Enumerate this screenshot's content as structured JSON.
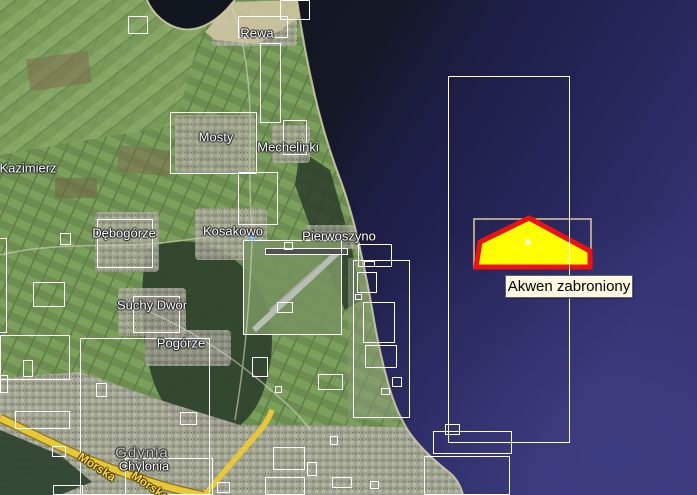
{
  "map": {
    "view_name": "satellite-map-coastal-bay",
    "restricted_area": {
      "label": "Akwen zabroniony",
      "polygon_points": "529,218 590,251 590,267 476,267 480,242",
      "fill_color": "#ffff00",
      "border_color": "#ee1111",
      "frame_rect": {
        "x": 474,
        "y": 219,
        "w": 117,
        "h": 49
      },
      "frame_color": "#dcc9a2",
      "marker_glyph": "✦"
    },
    "airport_icon": {
      "glyph": "✳",
      "x": 252,
      "y": 238
    },
    "overlay_frame_color": "#ffffff",
    "place_labels": [
      {
        "name": "rewa",
        "text": "Rewa",
        "x": 257,
        "y": 33,
        "style": "town"
      },
      {
        "name": "mosty",
        "text": "Mosty",
        "x": 216,
        "y": 137,
        "style": "town"
      },
      {
        "name": "mechelinki",
        "text": "Mechelinki",
        "x": 288,
        "y": 147,
        "style": "town"
      },
      {
        "name": "kazimierz",
        "text": "Kazimierz",
        "x": 28,
        "y": 168,
        "style": "town"
      },
      {
        "name": "debogorze",
        "text": "Dębogórze",
        "x": 124,
        "y": 233,
        "style": "town"
      },
      {
        "name": "kosakowo",
        "text": "Kosakowo",
        "x": 233,
        "y": 231,
        "style": "town"
      },
      {
        "name": "pierwoszyno",
        "text": "Pierwoszyno",
        "x": 339,
        "y": 236,
        "style": "town"
      },
      {
        "name": "suchy-dwor",
        "text": "Suchy Dwór",
        "x": 152,
        "y": 305,
        "style": "town"
      },
      {
        "name": "pogorze",
        "text": "Pogórze",
        "x": 181,
        "y": 343,
        "style": "town"
      },
      {
        "name": "gdynia",
        "text": "Gdynia",
        "x": 142,
        "y": 453,
        "style": "city"
      },
      {
        "name": "chylonia",
        "text": "Chylonia",
        "x": 144,
        "y": 466,
        "style": "town"
      },
      {
        "name": "morska-1",
        "text": "Morska",
        "x": 97,
        "y": 467,
        "style": "street",
        "rotation": 33
      },
      {
        "name": "morska-2",
        "text": "Morska",
        "x": 150,
        "y": 486,
        "style": "street",
        "rotation": 35
      }
    ],
    "overlay_rectangles": [
      [
        128,
        16,
        20,
        18
      ],
      [
        238,
        16,
        50,
        22
      ],
      [
        280,
        0,
        30,
        20
      ],
      [
        260,
        43,
        21,
        80
      ],
      [
        170,
        112,
        87,
        62
      ],
      [
        283,
        120,
        24,
        35
      ],
      [
        238,
        172,
        40,
        53
      ],
      [
        97,
        219,
        56,
        49
      ],
      [
        60,
        233,
        11,
        12
      ],
      [
        33,
        282,
        32,
        25
      ],
      [
        -14,
        238,
        21,
        95
      ],
      [
        133,
        296,
        47,
        37
      ],
      [
        0,
        335,
        70,
        45
      ],
      [
        23,
        360,
        10,
        17
      ],
      [
        80,
        338,
        130,
        157
      ],
      [
        243,
        240,
        99,
        95
      ],
      [
        265,
        248,
        83,
        7
      ],
      [
        284,
        242,
        9,
        8
      ],
      [
        277,
        302,
        16,
        11
      ],
      [
        353,
        260,
        57,
        158
      ],
      [
        358,
        244,
        34,
        23
      ],
      [
        364,
        261,
        11,
        6
      ],
      [
        357,
        272,
        20,
        21
      ],
      [
        355,
        294,
        7,
        6
      ],
      [
        363,
        302,
        32,
        41
      ],
      [
        365,
        345,
        32,
        23
      ],
      [
        392,
        377,
        10,
        10
      ],
      [
        381,
        388,
        9,
        7
      ],
      [
        252,
        357,
        16,
        20
      ],
      [
        318,
        374,
        25,
        16
      ],
      [
        275,
        386,
        7,
        7
      ],
      [
        96,
        383,
        11,
        14
      ],
      [
        15,
        411,
        55,
        18
      ],
      [
        52,
        446,
        14,
        11
      ],
      [
        180,
        412,
        17,
        13
      ],
      [
        125,
        458,
        88,
        37
      ],
      [
        217,
        482,
        13,
        11
      ],
      [
        53,
        485,
        30,
        10
      ],
      [
        273,
        447,
        32,
        23
      ],
      [
        307,
        462,
        10,
        14
      ],
      [
        265,
        477,
        40,
        18
      ],
      [
        330,
        436,
        8,
        9
      ],
      [
        332,
        477,
        20,
        11
      ],
      [
        370,
        481,
        9,
        8
      ],
      [
        445,
        424,
        15,
        11
      ],
      [
        433,
        431,
        79,
        23
      ],
      [
        424,
        456,
        86,
        39
      ],
      [
        448,
        76,
        122,
        367
      ],
      [
        0,
        375,
        8,
        18
      ]
    ]
  }
}
